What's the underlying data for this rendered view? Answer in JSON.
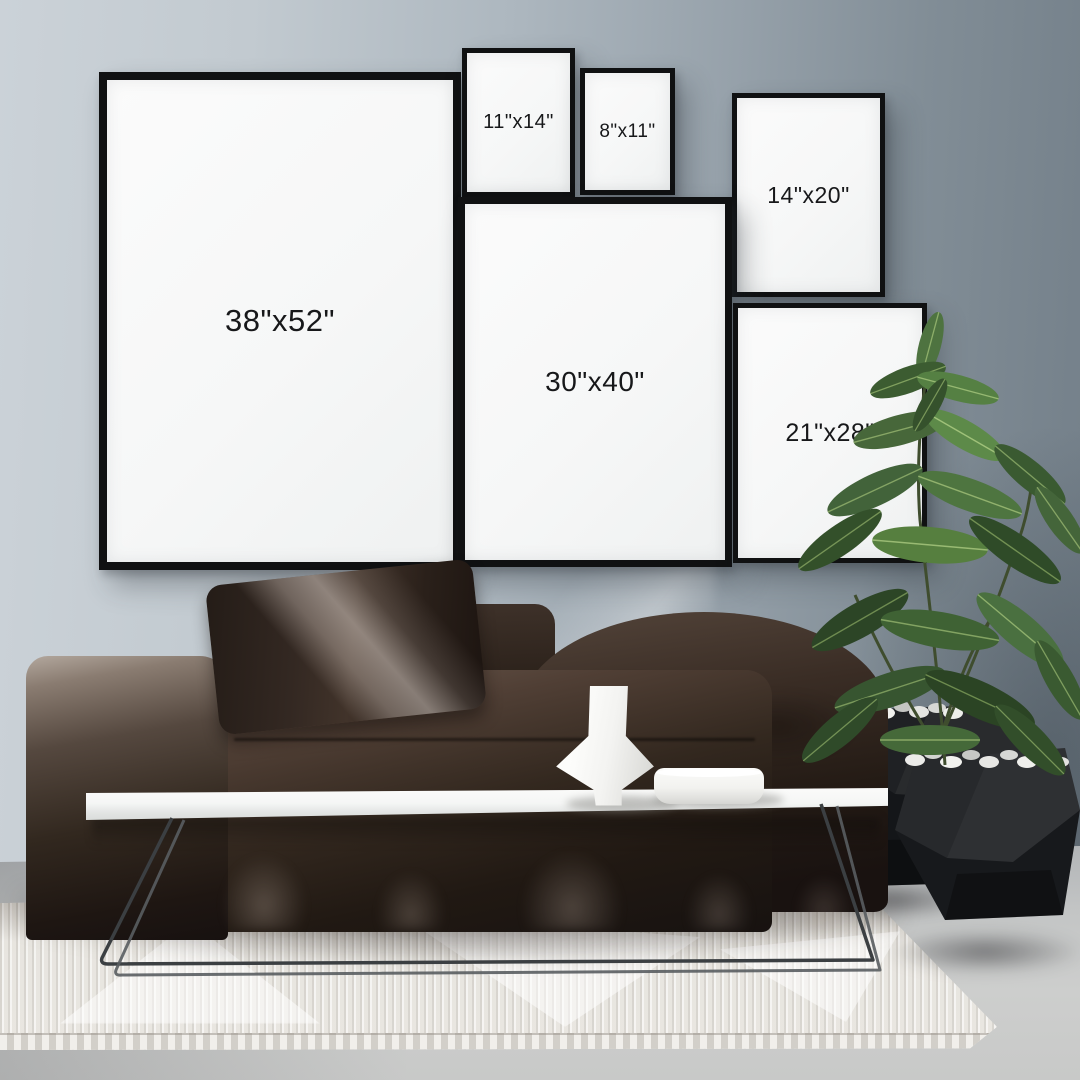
{
  "frames": [
    {
      "id": "38x52",
      "label": "38\"x52\""
    },
    {
      "id": "11x14",
      "label": "11\"x14\""
    },
    {
      "id": "8x11",
      "label": "8\"x11\""
    },
    {
      "id": "14x20",
      "label": "14\"x20\""
    },
    {
      "id": "30x40",
      "label": "30\"x40\""
    },
    {
      "id": "21x28",
      "label": "21\"x28\""
    }
  ],
  "palette": {
    "wall_light": "#cbd2d8",
    "wall_dark": "#737f89",
    "frame_border": "#101112",
    "frame_mat": "#f6f7f7",
    "label_text": "#17181a",
    "sofa_dark": "#1c1410",
    "sofa_mid": "#3a2d25",
    "sofa_highlight": "#b3a89e",
    "pillow": "#332822",
    "table_top": "#f5f6f5",
    "table_leg": "#3b3f42",
    "rug": "#e9e7e2",
    "floor": "#c8c9c8",
    "pot_black": "#141619",
    "pebbles": "#e9e9e6",
    "plant_green_dark": "#2c4526",
    "plant_green_mid": "#44663a",
    "plant_green_light": "#68954f",
    "vase_white": "#fdfdfb"
  }
}
